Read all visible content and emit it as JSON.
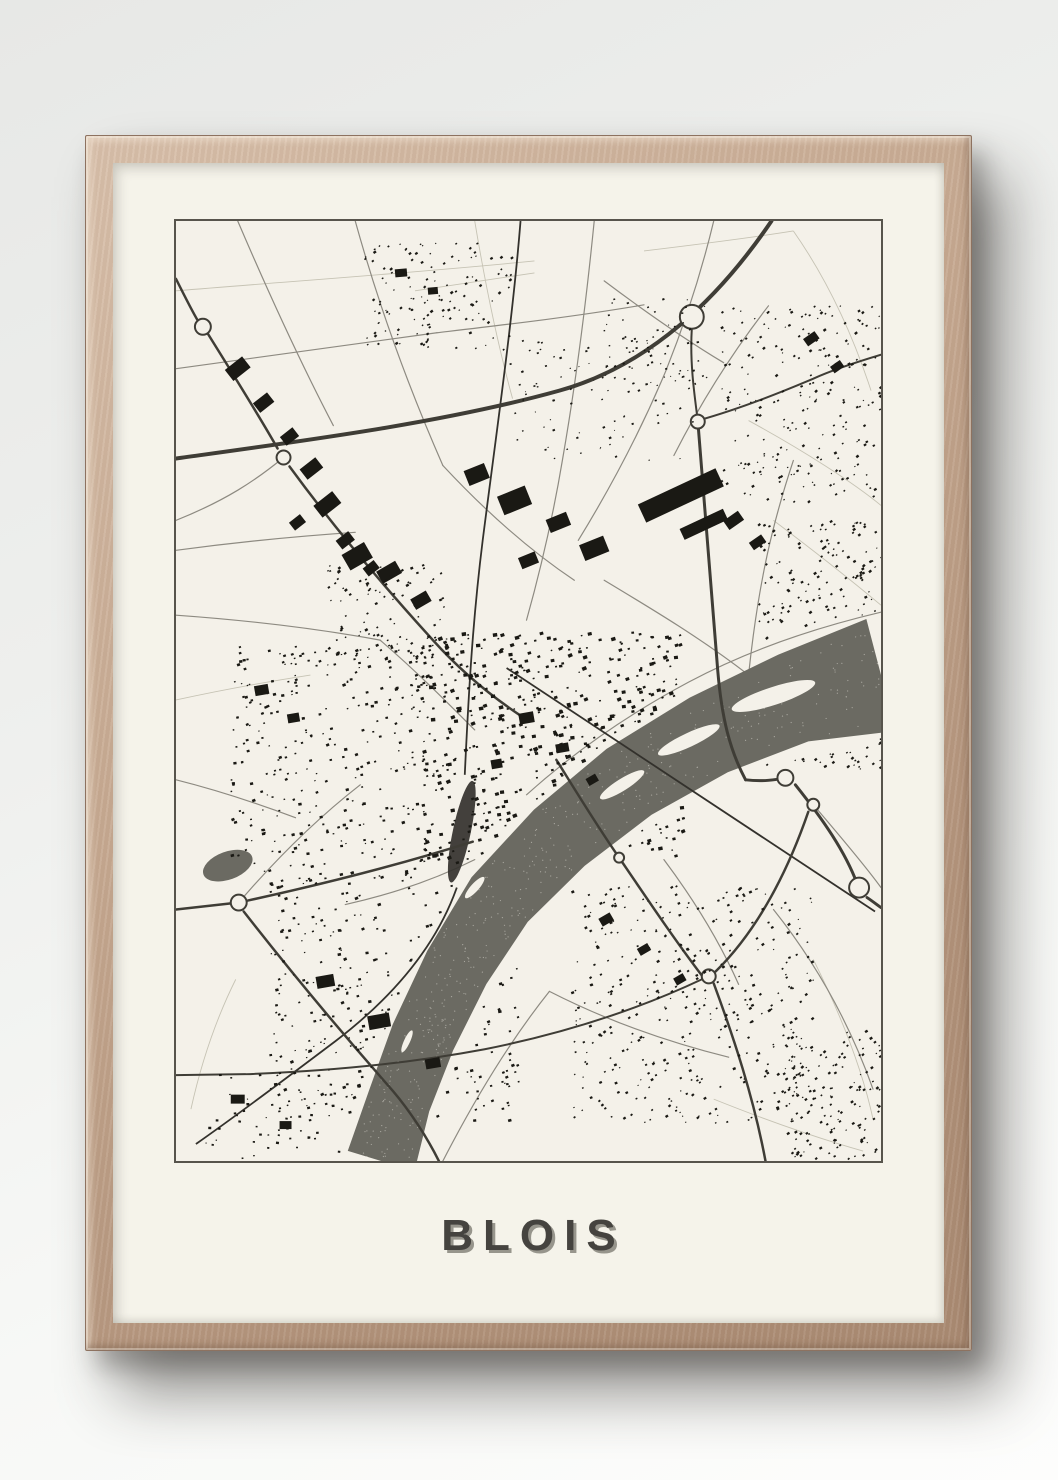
{
  "poster": {
    "title": "BLOIS"
  },
  "colors": {
    "mat": "#f5f3ea",
    "map_bg": "#f4f1e9",
    "map_border": "#57544c",
    "river": "#6b6a62",
    "river_speckle": "#f4f1e9",
    "building": "#1a1914",
    "road_major": "#3f3d36",
    "road_minor": "#8d8a81",
    "field_line": "#c6c3b4",
    "rail": "#33312c",
    "frame_wood": "#c6a991",
    "title_color": "#45433f",
    "title_shadow": "#97958c"
  },
  "map": {
    "view_w": 708,
    "view_h": 942,
    "river_center": [
      [
        708,
        455,
        58
      ],
      [
        620,
        478,
        46
      ],
      [
        535,
        515,
        42
      ],
      [
        455,
        562,
        40
      ],
      [
        385,
        618,
        38
      ],
      [
        325,
        680,
        36
      ],
      [
        282,
        748,
        34
      ],
      [
        248,
        818,
        33
      ],
      [
        224,
        882,
        32
      ],
      [
        206,
        942,
        35
      ]
    ],
    "islands": [
      [
        600,
        476,
        44,
        9,
        -18
      ],
      [
        515,
        520,
        34,
        7,
        -25
      ],
      [
        448,
        565,
        26,
        6,
        -32
      ],
      [
        300,
        668,
        14,
        4,
        -48
      ],
      [
        232,
        822,
        12,
        3,
        -65
      ]
    ],
    "lake": [
      52,
      646,
      26,
      14,
      -20
    ],
    "rail_paths": [
      "M346,0 C338,100 322,210 308,320 C298,400 294,470 290,555",
      "M282,668 C260,730 215,780 160,822 C120,852 70,890 20,925",
      "M332,448 L702,692"
    ],
    "rail_spindle": [
      287,
      612,
      9,
      52,
      12
    ],
    "major_roads": [
      {
        "d": "M0,238 C130,220 270,202 385,170 C475,145 545,78 598,0",
        "w": 4
      },
      {
        "d": "M518,108 C516,140 520,170 524,200",
        "w": 2
      },
      {
        "d": "M524,200 C532,300 538,380 544,450 C548,498 556,530 572,560",
        "w": 3
      },
      {
        "d": "M572,560 C590,562 602,560 612,558",
        "w": 3
      },
      {
        "d": "M622,565 C650,600 672,632 684,664",
        "w": 3
      },
      {
        "d": "M694,678 C700,682 705,686 708,688",
        "w": 3
      },
      {
        "d": "M635,592 C615,650 585,710 542,752",
        "w": 2.5
      },
      {
        "d": "M540,764 C560,818 580,878 592,942",
        "w": 2.5
      },
      {
        "d": "M528,760 C460,792 385,815 310,830 C230,845 150,852 70,855 L0,856",
        "w": 2
      },
      {
        "d": "M382,540 C402,572 422,605 445,638 C475,682 502,722 528,756",
        "w": 2.5
      },
      {
        "d": "M0,690 L54,684",
        "w": 2.5
      },
      {
        "d": "M72,681 C150,664 225,645 298,622",
        "w": 2.5
      },
      {
        "d": "M68,692 C115,752 165,812 218,872 C235,892 252,918 264,942",
        "w": 2.5
      },
      {
        "d": "M0,58 C8,74 16,90 22,100",
        "w": 2.5
      },
      {
        "d": "M32,113 C60,158 84,196 102,228",
        "w": 2.5
      },
      {
        "d": "M114,246 C155,302 205,362 258,420 C285,450 315,475 345,495",
        "w": 2.5
      },
      {
        "d": "M524,200 C560,190 600,175 640,158 C662,148 688,140 708,134",
        "w": 2
      }
    ],
    "minor_roads": [
      "M180,0 C205,90 235,170 268,245",
      "M268,245 C310,290 355,330 400,360",
      "M0,148 C90,136 180,124 262,112",
      "M262,112 C330,104 400,96 470,84",
      "M62,0 C92,70 124,140 158,205",
      "M420,0 C412,80 402,160 388,240 C378,300 366,350 352,400",
      "M540,0 C528,50 512,100 492,150 C466,212 436,268 404,320",
      "M595,85 C560,130 528,180 500,235",
      "M0,330 C60,322 120,316 180,312",
      "M0,395 C70,400 140,408 205,420",
      "M108,237 C80,260 50,280 0,300",
      "M430,360 C480,390 530,420 575,455",
      "M620,240 C600,300 585,360 575,455",
      "M575,455 C545,480 515,505 490,530",
      "M300,640 C260,660 215,675 170,685",
      "M63,683 C100,640 140,600 185,565",
      "M268,942 C300,880 335,822 375,772",
      "M375,772 C430,800 490,822 555,838",
      "M600,690 C640,740 675,800 700,870",
      "M640,585 C670,620 695,650 708,668",
      "M205,420 C240,450 270,480 300,510",
      "M0,560 C40,570 80,583 120,598",
      "M490,640 C520,680 545,720 565,765",
      "M430,60 C470,90 510,118 550,142",
      "M708,392 C640,408 575,430 515,462 C455,494 400,532 352,575"
    ],
    "field_lines": [
      "M0,70 C120,60 240,52 360,40",
      "M300,0 C310,60 322,120 338,178",
      "M470,30 C520,24 570,18 620,10",
      "M620,10 C655,60 680,115 698,170",
      "M575,200 C630,230 680,262 708,285",
      "M600,300 C640,330 678,360 708,385",
      "M0,480 C45,470 90,462 135,455",
      "M640,740 C665,790 688,845 700,900",
      "M540,880 C590,900 640,918 690,932",
      "M60,760 C40,800 25,845 15,890",
      "M240,70 C280,64 320,58 360,52"
    ],
    "roundabouts": [
      [
        27,
        106,
        8
      ],
      [
        108,
        237,
        7
      ],
      [
        518,
        96,
        12
      ],
      [
        524,
        201,
        7
      ],
      [
        612,
        558,
        8
      ],
      [
        640,
        585,
        6
      ],
      [
        686,
        668,
        10
      ],
      [
        63,
        683,
        8
      ],
      [
        535,
        757,
        7
      ],
      [
        445,
        638,
        5
      ]
    ],
    "blocks": [
      [
        62,
        148,
        22,
        14,
        -38
      ],
      [
        88,
        182,
        18,
        12,
        -38
      ],
      [
        114,
        216,
        16,
        11,
        -38
      ],
      [
        136,
        248,
        20,
        13,
        -38
      ],
      [
        152,
        284,
        24,
        15,
        -38
      ],
      [
        122,
        302,
        14,
        10,
        -38
      ],
      [
        170,
        320,
        16,
        11,
        -38
      ],
      [
        196,
        348,
        14,
        10,
        -38
      ],
      [
        302,
        254,
        22,
        16,
        -22
      ],
      [
        340,
        280,
        30,
        20,
        -22
      ],
      [
        384,
        302,
        22,
        14,
        -22
      ],
      [
        420,
        328,
        26,
        17,
        -22
      ],
      [
        354,
        340,
        18,
        12,
        -22
      ],
      [
        182,
        336,
        26,
        18,
        -30
      ],
      [
        214,
        352,
        22,
        14,
        -30
      ],
      [
        246,
        380,
        18,
        12,
        -30
      ],
      [
        507,
        275,
        86,
        20,
        -25
      ],
      [
        530,
        304,
        48,
        12,
        -25
      ],
      [
        560,
        300,
        18,
        11,
        -35
      ],
      [
        584,
        322,
        15,
        9,
        -35
      ],
      [
        638,
        118,
        14,
        9,
        -35
      ],
      [
        664,
        146,
        12,
        8,
        -35
      ],
      [
        352,
        498,
        15,
        11,
        -10
      ],
      [
        388,
        528,
        13,
        9,
        -10
      ],
      [
        322,
        544,
        11,
        9,
        -10
      ],
      [
        418,
        560,
        11,
        8,
        -30
      ],
      [
        150,
        762,
        18,
        12,
        -10
      ],
      [
        204,
        802,
        22,
        14,
        -10
      ],
      [
        258,
        844,
        15,
        10,
        -10
      ],
      [
        432,
        700,
        13,
        9,
        -30
      ],
      [
        470,
        730,
        12,
        8,
        -30
      ],
      [
        506,
        760,
        11,
        8,
        -30
      ],
      [
        226,
        52,
        12,
        8,
        -5
      ],
      [
        258,
        70,
        10,
        7,
        -5
      ],
      [
        62,
        880,
        14,
        9,
        0
      ],
      [
        110,
        906,
        12,
        8,
        0
      ],
      [
        86,
        470,
        14,
        10,
        -10
      ],
      [
        118,
        498,
        12,
        9,
        -10
      ]
    ],
    "clusters": [
      {
        "name": "village-north",
        "x": 190,
        "y": 22,
        "w": 150,
        "h": 108,
        "n": 130,
        "smin": 1.2,
        "smax": 3,
        "rot": -35,
        "seed": 11
      },
      {
        "name": "suburb-northeast",
        "x": 548,
        "y": 82,
        "w": 160,
        "h": 200,
        "n": 230,
        "smin": 1.2,
        "smax": 3,
        "rot": -35,
        "seed": 22
      },
      {
        "name": "band-east",
        "x": 585,
        "y": 300,
        "w": 123,
        "h": 250,
        "n": 300,
        "smin": 1.2,
        "smax": 3,
        "rot": -35,
        "seed": 33
      },
      {
        "name": "city-center",
        "x": 248,
        "y": 412,
        "w": 262,
        "h": 232,
        "n": 620,
        "smin": 1.5,
        "smax": 4.5,
        "rot": -15,
        "seed": 44
      },
      {
        "name": "res-west",
        "x": 55,
        "y": 425,
        "w": 205,
        "h": 235,
        "n": 330,
        "smin": 1.3,
        "smax": 3.4,
        "rot": -15,
        "seed": 55
      },
      {
        "name": "res-southwest",
        "x": 95,
        "y": 660,
        "w": 250,
        "h": 242,
        "n": 350,
        "smin": 1.3,
        "smax": 3.4,
        "rot": -15,
        "seed": 66
      },
      {
        "name": "suburb-southeast",
        "x": 398,
        "y": 665,
        "w": 245,
        "h": 240,
        "n": 400,
        "smin": 1.2,
        "smax": 3,
        "rot": -30,
        "seed": 77
      },
      {
        "name": "suburb-bottomright",
        "x": 612,
        "y": 812,
        "w": 96,
        "h": 128,
        "n": 150,
        "smin": 1.2,
        "smax": 3,
        "rot": -35,
        "seed": 88
      },
      {
        "name": "scatter-bottomleft",
        "x": 30,
        "y": 852,
        "w": 185,
        "h": 88,
        "n": 70,
        "smin": 1.2,
        "smax": 3,
        "rot": 0,
        "seed": 99
      },
      {
        "name": "scatter-midtop",
        "x": 335,
        "y": 120,
        "w": 190,
        "h": 122,
        "n": 90,
        "smin": 1,
        "smax": 2.6,
        "rot": -20,
        "seed": 12
      },
      {
        "name": "res-north-of-city",
        "x": 150,
        "y": 345,
        "w": 120,
        "h": 95,
        "n": 110,
        "smin": 1.3,
        "smax": 3.2,
        "rot": -30,
        "seed": 13
      },
      {
        "name": "scatter-ne-inner",
        "x": 430,
        "y": 78,
        "w": 110,
        "h": 90,
        "n": 60,
        "smin": 1,
        "smax": 2.4,
        "rot": -20,
        "seed": 14
      }
    ],
    "river_speckle_count": 450
  }
}
